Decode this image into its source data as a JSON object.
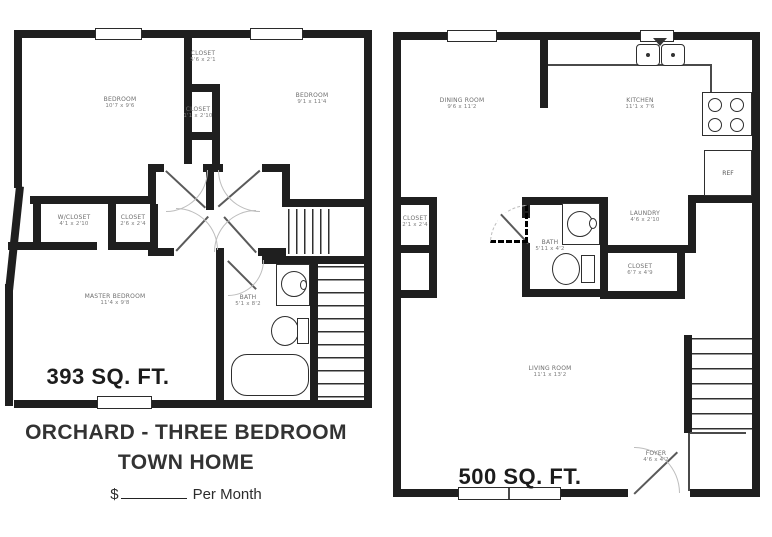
{
  "floor_upper": {
    "sqft_label": "393 SQ. FT.",
    "rooms": {
      "bedroom_left": {
        "name": "BEDROOM",
        "dims": "10'7 x 9'6"
      },
      "bedroom_right": {
        "name": "BEDROOM",
        "dims": "9'1 x 11'4"
      },
      "closet_top": {
        "name": "CLOSET",
        "dims": "5'6 x 2'1"
      },
      "closet_mid": {
        "name": "CLOSET",
        "dims": "1'1 x 2'10"
      },
      "w_closet": {
        "name": "W/CLOSET",
        "dims": "4'1 x 2'10"
      },
      "closet_hall": {
        "name": "CLOSET",
        "dims": "2'6 x 2'4"
      },
      "master_bedroom": {
        "name": "MASTER BEDROOM",
        "dims": "11'4 x 9'8"
      },
      "bath": {
        "name": "BATH",
        "dims": "5'1 x 8'2"
      }
    }
  },
  "floor_main": {
    "sqft_label": "500 SQ. FT.",
    "refrigerator_label": "REF",
    "rooms": {
      "dining": {
        "name": "DINING ROOM",
        "dims": "9'6 x 11'2"
      },
      "kitchen": {
        "name": "KITCHEN",
        "dims": "11'1 x 7'6"
      },
      "closet_entry": {
        "name": "CLOSET",
        "dims": "2'1 x 2'4"
      },
      "bath": {
        "name": "BATH",
        "dims": "5'11 x 4'2"
      },
      "laundry": {
        "name": "LAUNDRY",
        "dims": "4'6 x 2'10"
      },
      "closet_under_stairs": {
        "name": "CLOSET",
        "dims": "6'7 x 4'9"
      },
      "living": {
        "name": "LIVING ROOM",
        "dims": "11'1 x 13'2"
      },
      "foyer": {
        "name": "FOYER",
        "dims": "4'6 x 4'2"
      }
    }
  },
  "caption": {
    "title_line1": "ORCHARD - THREE BEDROOM",
    "title_line2": "TOWN HOME",
    "price_prefix": "$",
    "price_suffix": "Per Month"
  },
  "colors": {
    "wall": "#1f1f1f",
    "label": "#6e6e6e",
    "paper": "#ffffff"
  }
}
